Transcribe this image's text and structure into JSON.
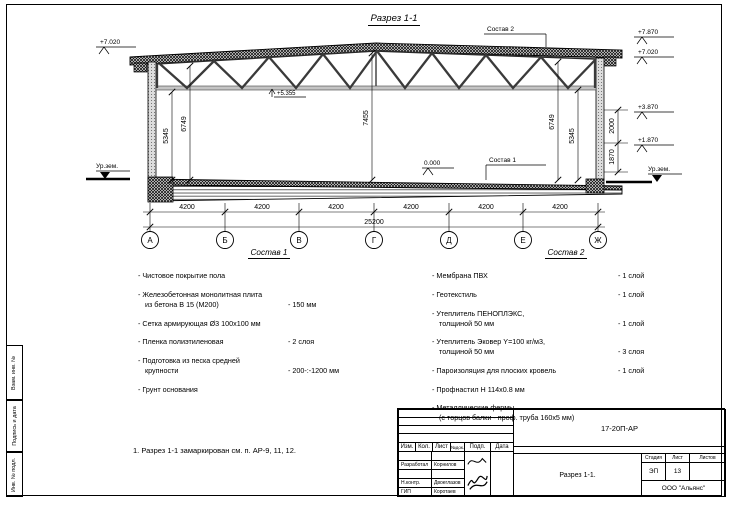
{
  "sheet": {
    "title": "Разрез 1-1",
    "note": "1. Разрез 1-1 замаркирован см. п. АР-9, 11, 12.",
    "margin_labels": [
      "Взам. инв. №",
      "Подпись и дата",
      "Инв. № подл."
    ]
  },
  "drawing": {
    "elev_left_top": "+7.020",
    "elev_right_1": "+7.870",
    "elev_right_2": "+7.020",
    "elev_right_3": "+3.870",
    "elev_right_4": "+1.870",
    "elev_truss": "+5.355",
    "elev_floor": "0.000",
    "ground_left": "Ур.зем.",
    "ground_right": "Ур.зем.",
    "dim_v1": "5345",
    "dim_v2": "6749",
    "dim_v3": "7455",
    "dim_v4": "6749",
    "dim_v5": "5345",
    "dim_r1": "2000",
    "dim_r2": "1870",
    "bay": "4200",
    "total": "25200",
    "axes": [
      "А",
      "Б",
      "В",
      "Г",
      "Д",
      "Е",
      "Ж"
    ],
    "label_sostav1": "Состав 1",
    "label_sostav2": "Состав 2"
  },
  "sostav1": {
    "heading": "Состав 1",
    "items": [
      {
        "text": "- Чистовое покрытие пола",
        "value": ""
      },
      {
        "text": "- Железобетонная  монолитная плита\nиз бетона В 15 (М200)",
        "value": "- 150 мм"
      },
      {
        "text": "- Сетка армирующая Ø3 100x100 мм",
        "value": ""
      },
      {
        "text": "- Пленка полиэтиленовая",
        "value": "- 2 слоя"
      },
      {
        "text": "- Подготовка из песка средней\nкрупности",
        "value": "- 200-:-1200 мм"
      },
      {
        "text": "- Грунт основания",
        "value": ""
      }
    ]
  },
  "sostav2": {
    "heading": "Состав 2",
    "items": [
      {
        "text": "- Мембрана ПВХ",
        "value": "- 1 слой"
      },
      {
        "text": "- Геотекстиль",
        "value": "- 1 слой"
      },
      {
        "text": "- Утеплитель ПЕНОПЛЭКС,\nтолщиной 50 мм",
        "value": "- 1 слой"
      },
      {
        "text": "- Утеплитель Эковер Y=100 кг/м3,\nтолщиной 50 мм",
        "value": "- 3 слоя"
      },
      {
        "text": "- Пароизоляция для плоских кровель",
        "value": "- 1 слой"
      },
      {
        "text": "- Профнастил Н 114x0.8 мм",
        "value": ""
      },
      {
        "text": "- Металлические фермы\n(с торцов балки - проф. труба 160х5 мм)",
        "value": ""
      }
    ]
  },
  "titleblock": {
    "doc_code": "17-20П-АР",
    "rev_headers": [
      "Изм.",
      "Кол.",
      "Лист",
      "№док.",
      "Подп.",
      "Дата"
    ],
    "rows": [
      {
        "role": "Разработал",
        "name": "Корнилов"
      },
      {
        "role": "Н.контр.",
        "name": "Двоеглазов"
      },
      {
        "role": "ГИП",
        "name": "Коротаев"
      }
    ],
    "stage_label": "Стадия",
    "sheet_label": "Лист",
    "sheets_label": "Листов",
    "stage": "ЭП",
    "sheet_no": "13",
    "sheets_total": "",
    "drawing_name": "Разрез 1-1.",
    "company": "ООО \"Альянс\""
  }
}
